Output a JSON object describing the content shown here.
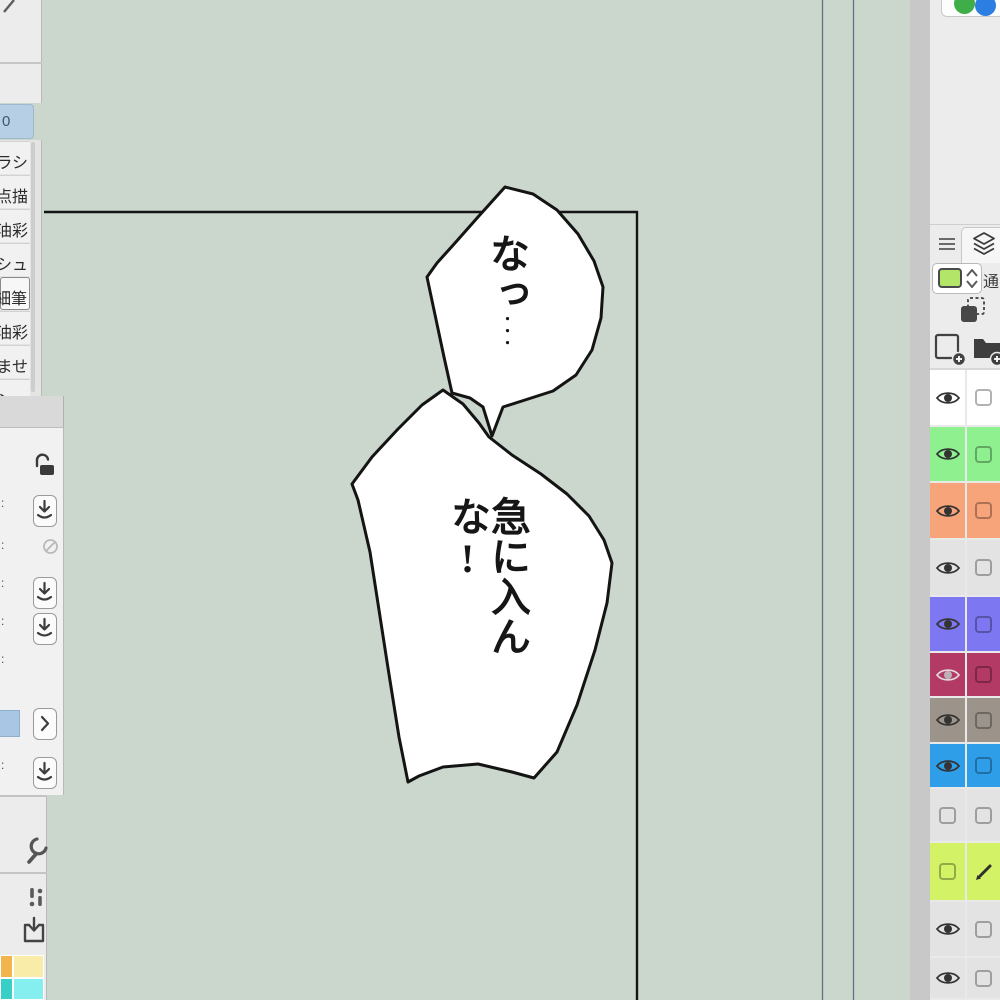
{
  "window": {
    "canvas_color": "#cbd7cc"
  },
  "left_panel": {
    "group_tab_label": "0",
    "tools": [
      {
        "label": "ラシ",
        "selected": false
      },
      {
        "label": "点描",
        "selected": false
      },
      {
        "label": "油彩",
        "selected": false
      },
      {
        "label": "シュ",
        "selected": false
      },
      {
        "label": "細筆",
        "selected": true
      },
      {
        "label": "油彩",
        "selected": false
      },
      {
        "label": "ませ",
        "selected": false
      },
      {
        "label": "シュ",
        "selected": false
      }
    ],
    "property_label_fragment": ":",
    "swatches": [
      "#f2b44c",
      "#f9eba8",
      "#38cfc6",
      "#85eff0"
    ]
  },
  "canvas": {
    "bubble1_text": "なっ",
    "bubble1_dots": "・・・",
    "bubble2_text": "急に入んな!"
  },
  "right_panel": {
    "blend_mode_fragment": "通",
    "layer_palette_color": "#b2e568",
    "top_widget": {
      "green_circle": "#3fae49",
      "blue_circle": "#2d7ee2"
    },
    "layers": [
      {
        "color": "#ffffff",
        "eye": "on",
        "right": "box"
      },
      {
        "color": "#8ef08f",
        "eye": "on",
        "right": "box"
      },
      {
        "color": "#f8a47a",
        "eye": "on",
        "right": "box"
      },
      {
        "color": "#e3e3e3",
        "eye": "on",
        "right": "box"
      },
      {
        "color": "#7d77f1",
        "eye": "on",
        "right": "box"
      },
      {
        "color": "#b23a64",
        "eye": "on-light",
        "right": "box"
      },
      {
        "color": "#9c948b",
        "eye": "on",
        "right": "box"
      },
      {
        "color": "#2f9ee9",
        "eye": "on",
        "right": "box"
      },
      {
        "color": "#e3e3e3",
        "eye": "off",
        "right": "box"
      },
      {
        "color": "#d4f266",
        "eye": "off",
        "right": "pencil"
      },
      {
        "color": "#e3e3e3",
        "eye": "on",
        "right": "box"
      },
      {
        "color": "#e3e3e3",
        "eye": "on",
        "right": "box"
      }
    ]
  }
}
